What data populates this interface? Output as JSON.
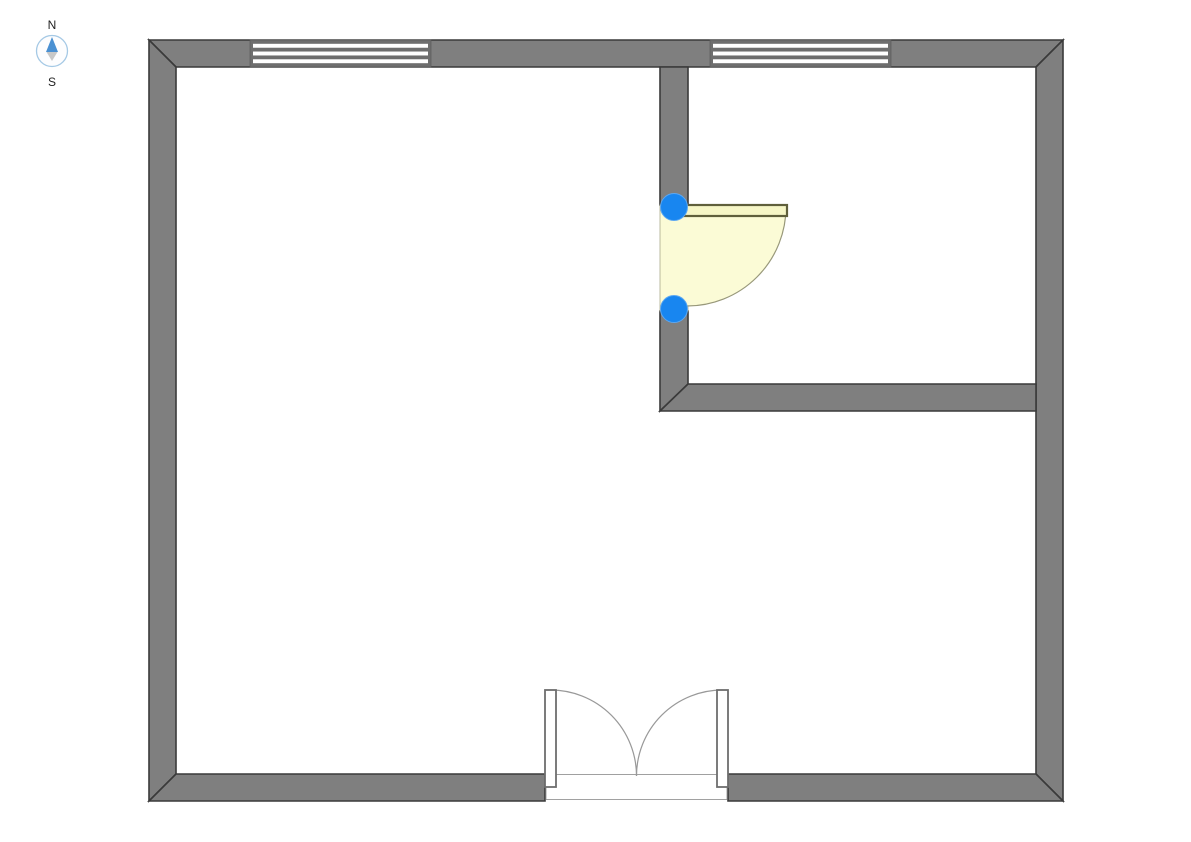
{
  "compass": {
    "north_label": "N",
    "south_label": "S",
    "ring_color": "#A5C9E5",
    "ring_fill": "#FDFDFE",
    "needle_north_color": "#4A90D2",
    "needle_south_color": "#C8C8C8",
    "label_color": "#222222"
  },
  "plan": {
    "background": "#FFFFFF",
    "colors": {
      "wall_fill": "#7F7F7F",
      "wall_stroke": "#3A3A3A",
      "window_fill": "#FFFFFF",
      "window_frame": "#6E6E6E",
      "window_outline": "#5A5A5A",
      "door_area_fill": "#FBFBD6",
      "door_strip_stroke": "#ABAB8B",
      "door_panel_fill": "#F6F6C6",
      "door_panel_stroke": "#5F5F3B",
      "door_arc_stroke": "#98987A",
      "opening_fill": "#FFFFFF",
      "opening_stroke": "#979797",
      "double_panel_fill": "#FFFFFF",
      "double_panel_stroke": "#6E6E6E",
      "double_arc_stroke": "#999999",
      "handle_fill": "#1886F0",
      "handle_ring": "#5BA7F2"
    },
    "walls": [
      {
        "name": "outer-wall-top",
        "points": [
          [
            149,
            40
          ],
          [
            1063,
            40
          ],
          [
            1036,
            67
          ],
          [
            176,
            67
          ]
        ]
      },
      {
        "name": "outer-wall-right",
        "points": [
          [
            1063,
            40
          ],
          [
            1063,
            801
          ],
          [
            1036,
            774
          ],
          [
            1036,
            67
          ]
        ]
      },
      {
        "name": "outer-wall-left",
        "points": [
          [
            149,
            801
          ],
          [
            149,
            40
          ],
          [
            176,
            67
          ],
          [
            176,
            774
          ]
        ]
      },
      {
        "name": "outer-wall-bottom-left-segment",
        "points": [
          [
            149,
            801
          ],
          [
            176,
            774
          ],
          [
            545,
            774
          ],
          [
            545,
            801
          ]
        ]
      },
      {
        "name": "outer-wall-bottom-right-segment",
        "points": [
          [
            728,
            801
          ],
          [
            728,
            774
          ],
          [
            1036,
            774
          ],
          [
            1063,
            801
          ]
        ]
      },
      {
        "name": "partition-wall-upper",
        "points": [
          [
            660,
            67
          ],
          [
            688,
            67
          ],
          [
            688,
            205
          ],
          [
            660,
            205
          ]
        ]
      },
      {
        "name": "partition-wall-lower",
        "points": [
          [
            660,
            311
          ],
          [
            688,
            311
          ],
          [
            688,
            384
          ],
          [
            660,
            411
          ]
        ]
      },
      {
        "name": "partition-wall-horizontal",
        "points": [
          [
            660,
            411
          ],
          [
            688,
            384
          ],
          [
            1036,
            384
          ],
          [
            1036,
            411
          ]
        ]
      }
    ],
    "windows": [
      {
        "name": "window-north-west",
        "x": 250,
        "y": 40,
        "width": 181,
        "height": 27
      },
      {
        "name": "window-north-east",
        "x": 710,
        "y": 40,
        "width": 181,
        "height": 27
      }
    ],
    "single_door": {
      "name": "interior-door",
      "selected": true,
      "wall_strip": {
        "x": 660,
        "y": 205,
        "width": 28,
        "height": 106
      },
      "hinge": {
        "x": 687,
        "y": 207
      },
      "radius": 99,
      "panel": {
        "x": 684,
        "y": 205,
        "width": 103,
        "height": 11
      },
      "handles": [
        {
          "name": "door-handle-start",
          "cx": 674,
          "cy": 207,
          "r": 13.5
        },
        {
          "name": "door-handle-end",
          "cx": 674,
          "cy": 309,
          "r": 13.5
        }
      ]
    },
    "double_door": {
      "name": "entry-double-door",
      "opening": {
        "x": 546,
        "y": 774.5,
        "width": 181,
        "height": 25
      },
      "wall_line_y": 776,
      "radius": 86,
      "meet_x": 636.5,
      "leaves": [
        {
          "name": "entry-door-left-leaf",
          "panel": {
            "x": 545,
            "y": 690,
            "width": 11,
            "height": 97
          },
          "hinge_x": 550.5,
          "sweep": 1
        },
        {
          "name": "entry-door-right-leaf",
          "panel": {
            "x": 717,
            "y": 690,
            "width": 11,
            "height": 97
          },
          "hinge_x": 722.5,
          "sweep": 0
        }
      ]
    }
  }
}
